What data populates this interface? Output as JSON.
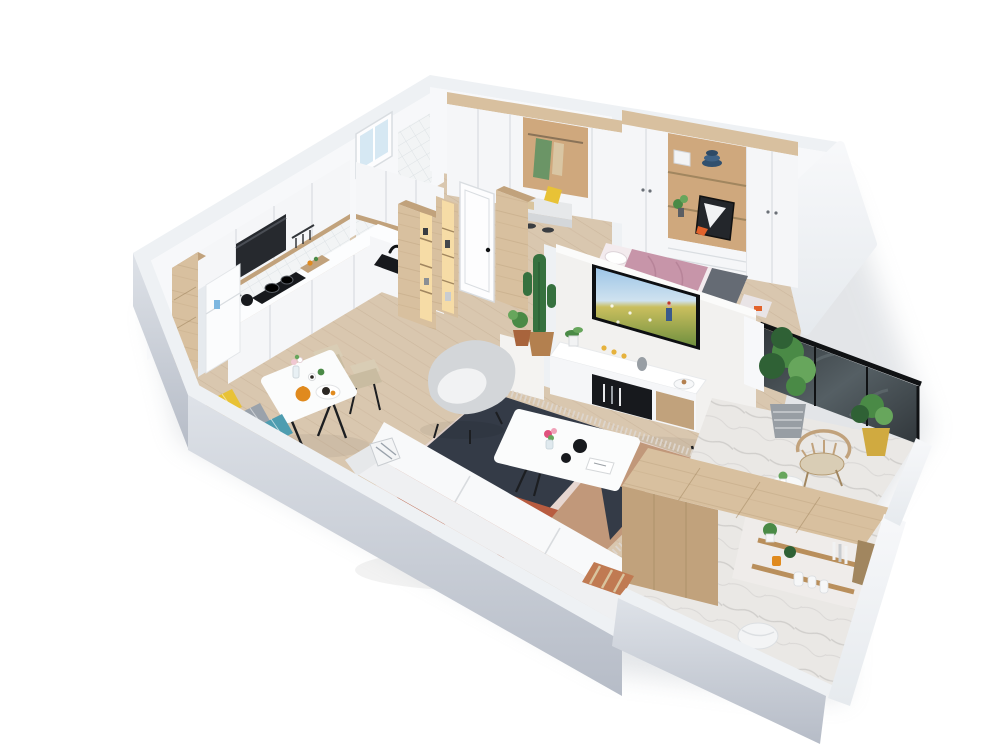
{
  "meta": {
    "type": "3d-isometric-apartment-floorplan-render",
    "view": "cutaway-axonometric",
    "background": "#ffffff"
  },
  "scene": {
    "rooms": [
      {
        "name": "kitchen",
        "items": [
          "upper-cabinets",
          "range-hood",
          "gas-cooktop",
          "kettle",
          "cutting-board",
          "sink-with-faucet",
          "backsplash-tiles",
          "window",
          "fridge",
          "wood-drawer-column",
          "pantry-tower-with-lit-shelves"
        ]
      },
      {
        "name": "entry-hall",
        "items": [
          "entry-wardrobe",
          "open-closet-with-clothes",
          "bench-with-yellow-pillow",
          "shoes",
          "white-interior-door",
          "wood-columns",
          "lit-shelf-column"
        ]
      },
      {
        "name": "bedroom",
        "items": [
          "wardrobe-wall",
          "display-niche",
          "storage-box",
          "hat-stack",
          "picture-frame",
          "drawers",
          "double-bed-pink",
          "gray-foot-blanket",
          "foot-bench"
        ]
      },
      {
        "name": "living-room",
        "items": [
          "tv-partition-wall",
          "wall-mounted-tv-meadow-scene",
          "wall-switches",
          "tv-console",
          "cactus-plant",
          "copper-pot-plant",
          "geometric-area-rug",
          "coffee-table",
          "flower-vase",
          "black-bowls",
          "magazine",
          "sofa",
          "striped-pillow",
          "armchair"
        ]
      },
      {
        "name": "dining-area",
        "items": [
          "white-dining-table",
          "beige-chairs",
          "orange-teapot",
          "food-plate",
          "flower-vase",
          "window-bench",
          "yellow-pillow",
          "gray-pillow",
          "teal-pillow"
        ]
      },
      {
        "name": "balcony",
        "items": [
          "marble-floor",
          "black-framed-glass-railing",
          "large-potted-plant",
          "striped-gray-pot",
          "small-plant-gold-pot",
          "wood-spindle-chair",
          "white-side-table"
        ]
      },
      {
        "name": "utility-balcony",
        "items": [
          "marble-floor",
          "wood-clad-wall",
          "wall-shelves",
          "white-jars",
          "orange-cup",
          "shelf-plants",
          "books",
          "laundry-basket",
          "striped-door-mat"
        ]
      }
    ]
  },
  "palette": {
    "bg": "#ffffff",
    "shadow": "#a9b0ba",
    "wall_top": "#eef1f4",
    "wall_front_light": "#dee2e8",
    "wall_front_dark": "#b6bcc7",
    "wall_white": "#f7f8fa",
    "wall_white_shade": "#e6eaee",
    "floor_wood": "#d9c7af",
    "floor_wood_line": "#a5876a",
    "floor_marble": "#eae8e5",
    "marble_streak": "#bab8b6",
    "cabinet_white": "#f5f6f8",
    "cabinet_line": "#d9dde1",
    "counter_white": "#fcfdfe",
    "backsplash": "#f2f4f5",
    "tile_line": "#dde2e5",
    "hood_black": "#26292e",
    "appliance_black": "#17191d",
    "wood_light": "#d8c09f",
    "wood_mid": "#c1a27c",
    "wood_dark": "#a1865f",
    "niche_glow": "#f6dca6",
    "fridge_white": "#fbfcfd",
    "door_white": "#fdfdfe",
    "tv_frame": "#0d0f12",
    "tv_sky": "#9dc5e7",
    "tv_sky2": "#cfe2ef",
    "tv_field": "#cabf5e",
    "tv_field_dark": "#70903f",
    "window_glass": "#d6e8f3",
    "bed_pink": "#c795a9",
    "bed_blanket": "#656b74",
    "bed_sheet": "#f3ebee",
    "sofa_white": "#eff0f2",
    "sofa_seat": "#f8f9fa",
    "sofa_line": "#d8dbde",
    "armchair_gray": "#d3d6d9",
    "armchair_cushion": "#f1f2f3",
    "rug_charcoal": "#343b47",
    "rug_terracotta": "#b85c40",
    "rug_blush": "#e7d7d1",
    "rug_tan": "#c1987a",
    "rug_fringe": "#ddd5cc",
    "pillow_yellow": "#e8c236",
    "pillow_gray": "#9aa2ab",
    "pillow_teal": "#4e9db0",
    "plant_green": "#4a8a46",
    "plant_green_dark": "#2f6135",
    "plant_green_light": "#67a65c",
    "cactus_green": "#36713f",
    "pot_terracotta": "#b3804f",
    "pot_gray": "#989ea4",
    "pot_gold": "#d0aa40",
    "pot_copper": "#a8643c",
    "glass_dark": "#31373b",
    "glass_light": "#555f64",
    "frame_black": "#101214",
    "table_white": "#fbfcfc",
    "chair_beige": "#d9cdb5",
    "chair_beige_dark": "#c9bca1",
    "teapot_orange": "#e08a1e",
    "food_dark": "#2b2723",
    "accent_orange": "#e2622b",
    "clothes_green": "#6b9566",
    "clothes_beige": "#d9c6a3",
    "closet_niche": "#cfa87d",
    "box_white": "#f2f3f5",
    "hat_navy": "#31506e",
    "candle_amber": "#e6b23c",
    "mat_rust": "#c07a52",
    "mat_tan": "#d9c49e",
    "leg_black": "#1c1e21",
    "shelf_wood": "#b98f5c"
  }
}
